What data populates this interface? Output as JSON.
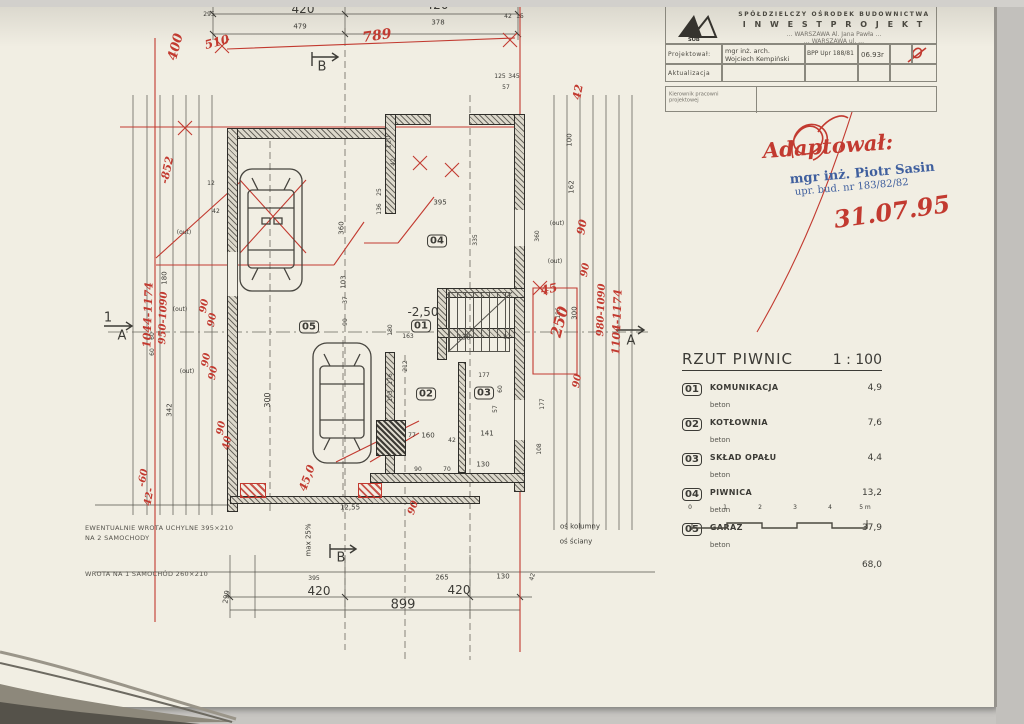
{
  "title_block": {
    "company_line1": "SPÓŁDZIELCZY OŚRODEK BUDOWNICTWA",
    "company_line2": "I N W E S T P R O J E K T",
    "addr1": "… WARSZAWA  Al. Jana Pawła …",
    "addr2": "… WARSZAWA  ul. …",
    "logo_text": "SOB",
    "projektowal_label": "Projektował:",
    "projektowal_name1": "mgr inż. arch.",
    "projektowal_name2": "Wojciech Kempiński",
    "upr": "BPP Upr 188/81",
    "date": "06.93r",
    "aktualizacja_label": "Aktualizacja",
    "kierownik_line1": "Kierownik pracowni",
    "kierownik_line2": "projektowej"
  },
  "stamps": {
    "adaptowal": "Adaptował:",
    "stamp_name": "mgr inż. Piotr Sasin",
    "stamp_upr": "upr. bud. nr 183/82/82",
    "date_red": "31.07.95"
  },
  "legend": {
    "title": "RZUT PIWNIC",
    "scale": "1 : 100",
    "rows": [
      {
        "num": "01",
        "name": "KOMUNIKACJA",
        "material": "beton",
        "area": "4,9"
      },
      {
        "num": "02",
        "name": "KOTŁOWNIA",
        "material": "beton",
        "area": "7,6"
      },
      {
        "num": "03",
        "name": "SKŁAD OPAŁU",
        "material": "beton",
        "area": "4,4"
      },
      {
        "num": "04",
        "name": "PIWNICA",
        "material": "beton",
        "area": "13,2"
      },
      {
        "num": "05",
        "name": "GARAŻ",
        "material": "beton",
        "area": "37,9"
      }
    ],
    "total": "68,0"
  },
  "scalebar_marks": [
    {
      "t": "0",
      "x": 0
    },
    {
      "t": "1",
      "x": 35
    },
    {
      "t": "2",
      "x": 70
    },
    {
      "t": "3",
      "x": 105
    },
    {
      "t": "4",
      "x": 140
    },
    {
      "t": "5 m",
      "x": 175
    }
  ],
  "notes": {
    "note1a": "EWENTUALNIE WROTA UCHYLNE  395×210",
    "note1b": "NA 2 SAMOCHODY",
    "note2": "WROTA NA 1 SAMOCHÓD   260×210"
  },
  "markers": {
    "a": "A",
    "b": "B",
    "one": "1"
  },
  "rooms": [
    {
      "t": "01",
      "x": 421,
      "y": 326
    },
    {
      "t": "02",
      "x": 426,
      "y": 394
    },
    {
      "t": "03",
      "x": 484,
      "y": 393
    },
    {
      "t": "04",
      "x": 437,
      "y": 241
    },
    {
      "t": "05",
      "x": 309,
      "y": 327
    }
  ],
  "plan_labels": [
    {
      "t": "295",
      "x": 209,
      "y": 15,
      "fs": 6
    },
    {
      "t": "420",
      "x": 303,
      "y": 9,
      "fs": 12
    },
    {
      "t": "479",
      "x": 300,
      "y": 27,
      "fs": 7
    },
    {
      "t": "420",
      "x": 437,
      "y": 5,
      "fs": 12
    },
    {
      "t": "378",
      "x": 438,
      "y": 23,
      "fs": 7
    },
    {
      "t": "42",
      "x": 508,
      "y": 17,
      "fs": 6
    },
    {
      "t": "15",
      "x": 520,
      "y": 17,
      "fs": 6
    },
    {
      "t": "125",
      "x": 500,
      "y": 77,
      "fs": 6
    },
    {
      "t": "345",
      "x": 514,
      "y": 77,
      "fs": 6
    },
    {
      "t": "57",
      "x": 506,
      "y": 88,
      "fs": 6
    },
    {
      "t": "120",
      "x": 389,
      "y": 142,
      "rot": -90,
      "fs": 7
    },
    {
      "t": "42",
      "x": 394,
      "y": 162,
      "rot": -90,
      "fs": 6
    },
    {
      "t": "12",
      "x": 211,
      "y": 184,
      "fs": 6
    },
    {
      "t": "42",
      "x": 216,
      "y": 212,
      "fs": 6
    },
    {
      "t": "180",
      "x": 165,
      "y": 278,
      "rot": -90,
      "fs": 7
    },
    {
      "t": "60",
      "x": 153,
      "y": 336,
      "rot": -90,
      "fs": 6
    },
    {
      "t": "60",
      "x": 153,
      "y": 352,
      "rot": -90,
      "fs": 6
    },
    {
      "t": "342",
      "x": 170,
      "y": 410,
      "rot": -90,
      "fs": 7
    },
    {
      "t": "300",
      "x": 268,
      "y": 400,
      "rot": -90,
      "fs": 8
    },
    {
      "t": "(out)",
      "x": 184,
      "y": 233,
      "fs": 6
    },
    {
      "t": "(out)",
      "x": 180,
      "y": 310,
      "fs": 6
    },
    {
      "t": "(out)",
      "x": 187,
      "y": 372,
      "fs": 6
    },
    {
      "t": "(out)",
      "x": 557,
      "y": 224,
      "fs": 6
    },
    {
      "t": "(out)",
      "x": 555,
      "y": 262,
      "fs": 6
    },
    {
      "t": "395",
      "x": 440,
      "y": 203,
      "fs": 7
    },
    {
      "t": "25",
      "x": 380,
      "y": 192,
      "rot": -90,
      "fs": 6
    },
    {
      "t": "136",
      "x": 380,
      "y": 209,
      "rot": -90,
      "fs": 6
    },
    {
      "t": "360",
      "x": 342,
      "y": 228,
      "rot": -90,
      "fs": 7
    },
    {
      "t": "103",
      "x": 344,
      "y": 282,
      "rot": -90,
      "fs": 7
    },
    {
      "t": "37",
      "x": 346,
      "y": 300,
      "rot": -90,
      "fs": 6
    },
    {
      "t": "90",
      "x": 346,
      "y": 322,
      "rot": -90,
      "fs": 6
    },
    {
      "t": "335",
      "x": 476,
      "y": 240,
      "rot": -90,
      "fs": 6
    },
    {
      "t": "-2,50",
      "x": 423,
      "y": 312,
      "fs": 12
    },
    {
      "t": "163",
      "x": 408,
      "y": 337,
      "fs": 6
    },
    {
      "t": "180",
      "x": 391,
      "y": 330,
      "rot": -90,
      "fs": 6
    },
    {
      "t": "138",
      "x": 464,
      "y": 338,
      "fs": 7
    },
    {
      "t": "82",
      "x": 507,
      "y": 338,
      "fs": 6
    },
    {
      "t": "212",
      "x": 406,
      "y": 366,
      "rot": -90,
      "fs": 6
    },
    {
      "t": "176",
      "x": 391,
      "y": 379,
      "rot": -90,
      "fs": 6
    },
    {
      "t": "103",
      "x": 391,
      "y": 396,
      "rot": -90,
      "fs": 6
    },
    {
      "t": "177",
      "x": 484,
      "y": 376,
      "fs": 6
    },
    {
      "t": "60",
      "x": 501,
      "y": 389,
      "rot": -90,
      "fs": 6
    },
    {
      "t": "57",
      "x": 496,
      "y": 409,
      "rot": -90,
      "fs": 6
    },
    {
      "t": "177",
      "x": 543,
      "y": 404,
      "rot": -90,
      "fs": 6
    },
    {
      "t": "108",
      "x": 540,
      "y": 449,
      "rot": -90,
      "fs": 6
    },
    {
      "t": "77",
      "x": 412,
      "y": 436,
      "fs": 6
    },
    {
      "t": "160",
      "x": 428,
      "y": 436,
      "fs": 7
    },
    {
      "t": "42",
      "x": 452,
      "y": 441,
      "fs": 6
    },
    {
      "t": "141",
      "x": 487,
      "y": 434,
      "fs": 7
    },
    {
      "t": "90",
      "x": 418,
      "y": 470,
      "fs": 6
    },
    {
      "t": "70",
      "x": 447,
      "y": 470,
      "fs": 6
    },
    {
      "t": "130",
      "x": 483,
      "y": 465,
      "fs": 7
    },
    {
      "t": "100",
      "x": 570,
      "y": 140,
      "rot": -90,
      "fs": 7
    },
    {
      "t": "162",
      "x": 572,
      "y": 187,
      "rot": -90,
      "fs": 7
    },
    {
      "t": "360",
      "x": 538,
      "y": 236,
      "rot": -90,
      "fs": 6
    },
    {
      "t": "300",
      "x": 575,
      "y": 313,
      "rot": -90,
      "fs": 7
    },
    {
      "t": "186",
      "x": 559,
      "y": 313,
      "rot": -90,
      "fs": 6
    },
    {
      "t": "12,55",
      "x": 350,
      "y": 508,
      "fs": 7
    },
    {
      "t": "max 25%",
      "x": 309,
      "y": 540,
      "rot": -90,
      "fs": 7
    },
    {
      "t": "299",
      "x": 227,
      "y": 597,
      "rot": -80,
      "fs": 7
    },
    {
      "t": "395",
      "x": 314,
      "y": 579,
      "fs": 6
    },
    {
      "t": "420",
      "x": 319,
      "y": 591,
      "fs": 12
    },
    {
      "t": "899",
      "x": 403,
      "y": 605,
      "fs": 13
    },
    {
      "t": "265",
      "x": 442,
      "y": 578,
      "fs": 7
    },
    {
      "t": "130",
      "x": 503,
      "y": 577,
      "fs": 7
    },
    {
      "t": "420",
      "x": 459,
      "y": 590,
      "fs": 12
    },
    {
      "t": "42",
      "x": 533,
      "y": 577,
      "rot": -75,
      "fs": 6
    },
    {
      "t": "oś kolumny",
      "x": 580,
      "y": 527,
      "fs": 7
    },
    {
      "t": "oś ściany",
      "x": 576,
      "y": 542,
      "fs": 7
    }
  ],
  "red_notes": [
    {
      "t": "400",
      "x": 176,
      "y": 47,
      "rot": -75,
      "fs": 13
    },
    {
      "t": "510",
      "x": 217,
      "y": 42,
      "rot": -15,
      "fs": 12
    },
    {
      "t": "789",
      "x": 377,
      "y": 36,
      "rot": -8,
      "fs": 14
    },
    {
      "t": "-852",
      "x": 167,
      "y": 170,
      "rot": -78,
      "fs": 11
    },
    {
      "t": "90",
      "x": 205,
      "y": 306,
      "rot": -80,
      "fs": 10
    },
    {
      "t": "90",
      "x": 213,
      "y": 320,
      "rot": -80,
      "fs": 10
    },
    {
      "t": "1044-1174",
      "x": 148,
      "y": 315,
      "rot": -88,
      "fs": 11
    },
    {
      "t": "950-1090",
      "x": 164,
      "y": 318,
      "rot": -88,
      "fs": 10
    },
    {
      "t": "90",
      "x": 207,
      "y": 360,
      "rot": -80,
      "fs": 10
    },
    {
      "t": "90",
      "x": 214,
      "y": 373,
      "rot": -80,
      "fs": 10
    },
    {
      "t": "90",
      "x": 222,
      "y": 428,
      "rot": -80,
      "fs": 10
    },
    {
      "t": "40",
      "x": 228,
      "y": 443,
      "rot": -80,
      "fs": 10
    },
    {
      "t": "-60",
      "x": 144,
      "y": 478,
      "rot": -80,
      "fs": 10
    },
    {
      "t": "42-",
      "x": 150,
      "y": 497,
      "rot": -80,
      "fs": 10
    },
    {
      "t": "42",
      "x": 578,
      "y": 92,
      "rot": -80,
      "fs": 11
    },
    {
      "t": "90",
      "x": 582,
      "y": 227,
      "rot": -80,
      "fs": 11
    },
    {
      "t": "90",
      "x": 586,
      "y": 270,
      "rot": -80,
      "fs": 10
    },
    {
      "t": "45",
      "x": 549,
      "y": 289,
      "rot": -12,
      "fs": 12
    },
    {
      "t": "250",
      "x": 560,
      "y": 322,
      "rot": -75,
      "fs": 15
    },
    {
      "t": "980-1090",
      "x": 602,
      "y": 310,
      "rot": -88,
      "fs": 10
    },
    {
      "t": "1104-1174",
      "x": 617,
      "y": 322,
      "rot": -88,
      "fs": 11
    },
    {
      "t": "90",
      "x": 578,
      "y": 381,
      "rot": -80,
      "fs": 10
    },
    {
      "t": "45,0",
      "x": 307,
      "y": 478,
      "rot": -70,
      "fs": 11
    },
    {
      "t": "90",
      "x": 414,
      "y": 508,
      "rot": -70,
      "fs": 10
    }
  ]
}
